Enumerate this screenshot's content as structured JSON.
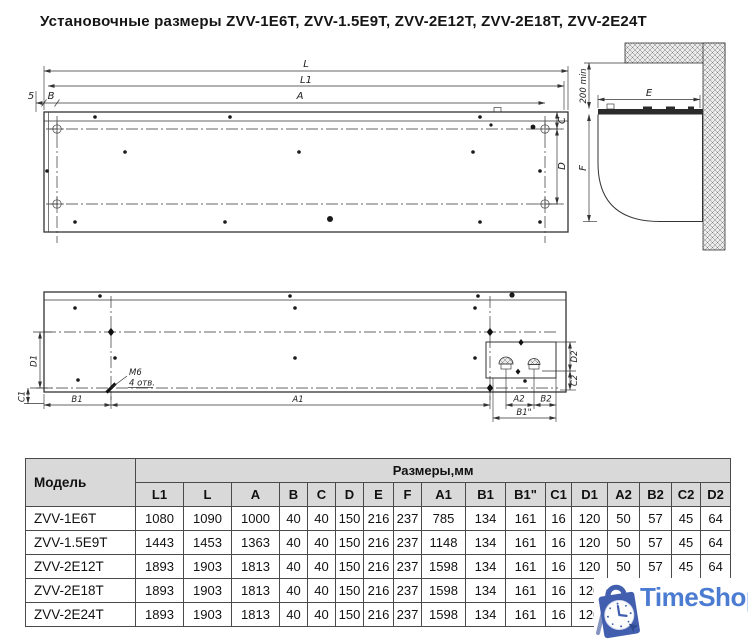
{
  "title": "Установочные размеры ZVV-1E6T, ZVV-1.5E9T, ZVV-2E12T, ZVV-2E18T, ZVV-2E24T",
  "drawing": {
    "top_view": {
      "l": "L",
      "l1": "L1",
      "a": "A",
      "gap": "5",
      "b": "B",
      "c": "C",
      "d": "D"
    },
    "side_view": {
      "e": "E",
      "f": "F",
      "clearance": "200 min"
    },
    "bottom_view": {
      "b1": "B1",
      "a1": "A1",
      "a2": "A2",
      "b2": "B2",
      "b1_sec": "B1\"",
      "c1": "C1",
      "d1": "D1",
      "c2": "C2",
      "d2": "D2",
      "thread": "M6",
      "holes_note": "4 отв."
    }
  },
  "table": {
    "model_header": "Модель",
    "sizes_header": "Размеры,мм",
    "columns": [
      "L1",
      "L",
      "A",
      "B",
      "C",
      "D",
      "E",
      "F",
      "A1",
      "B1",
      "B1\"",
      "C1",
      "D1",
      "A2",
      "B2",
      "C2",
      "D2"
    ],
    "rows": [
      {
        "model": "ZVV-1E6T",
        "values": [
          "1080",
          "1090",
          "1000",
          "40",
          "40",
          "150",
          "216",
          "237",
          "785",
          "134",
          "161",
          "16",
          "120",
          "50",
          "57",
          "45",
          "64"
        ]
      },
      {
        "model": "ZVV-1.5E9T",
        "values": [
          "1443",
          "1453",
          "1363",
          "40",
          "40",
          "150",
          "216",
          "237",
          "1148",
          "134",
          "161",
          "16",
          "120",
          "50",
          "57",
          "45",
          "64"
        ]
      },
      {
        "model": "ZVV-2E12T",
        "values": [
          "1893",
          "1903",
          "1813",
          "40",
          "40",
          "150",
          "216",
          "237",
          "1598",
          "134",
          "161",
          "16",
          "120",
          "50",
          "57",
          "45",
          "64"
        ]
      },
      {
        "model": "ZVV-2E18T",
        "values": [
          "1893",
          "1903",
          "1813",
          "40",
          "40",
          "150",
          "216",
          "237",
          "1598",
          "134",
          "161",
          "16",
          "120",
          "50",
          "57",
          "45",
          "64"
        ]
      },
      {
        "model": "ZVV-2E24T",
        "values": [
          "1893",
          "1903",
          "1813",
          "40",
          "40",
          "150",
          "216",
          "237",
          "1598",
          "134",
          "161",
          "16",
          "120",
          "50",
          "57",
          "45",
          "64"
        ]
      }
    ]
  },
  "watermark": {
    "text": "TimeShop"
  },
  "colors": {
    "header_gray": "#d9d9d9",
    "line": "#333333",
    "brand_blue": "#4c7cd2",
    "bag_blue": "#415fae"
  }
}
